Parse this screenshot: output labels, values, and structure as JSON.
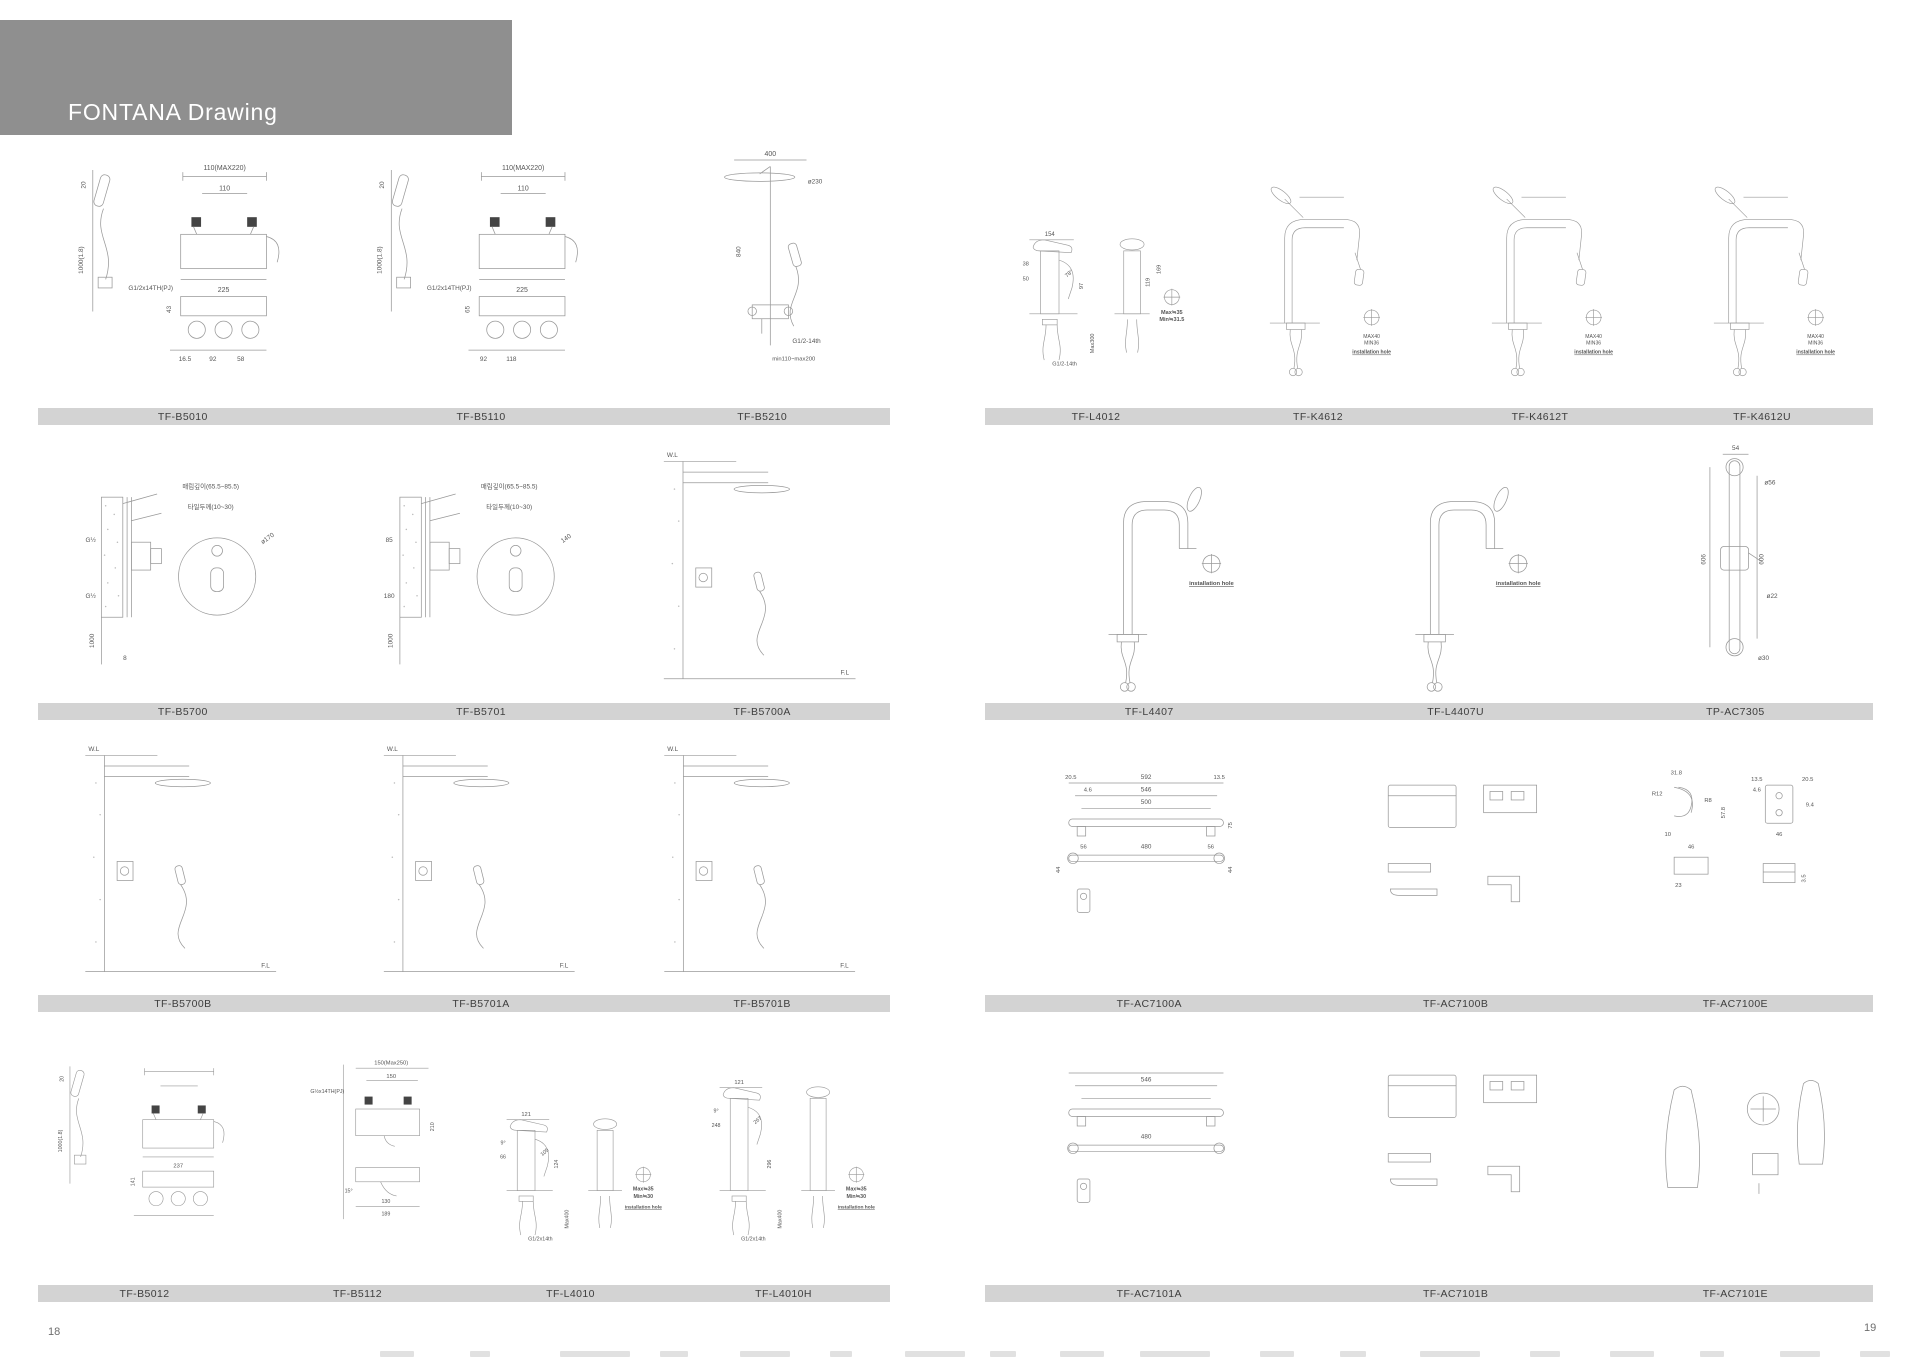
{
  "header": {
    "title": "FONTANA Drawing"
  },
  "colors": {
    "header_bar": "#8f8f8f",
    "label_bar": "#d3d3d3",
    "line": "#999999",
    "dim_text": "#555555"
  },
  "pages": [
    {
      "number": "18",
      "rows": [
        {
          "items": [
            {
              "label": "TF-B5010",
              "kind": "tub-mixer-hs",
              "annotations": [
                "110(MAX220)",
                "110",
                "20",
                "1000(1.8)",
                "G1/2x14TH(PJ)",
                "225",
                "43",
                "16.5",
                "92",
                "58"
              ]
            },
            {
              "label": "TF-B5110",
              "kind": "tub-mixer-hs",
              "annotations": [
                "110(MAX220)",
                "110",
                "20",
                "1000(1.8)",
                "G1/2x14TH(PJ)",
                "225",
                "65",
                "92",
                "118",
                ""
              ]
            },
            {
              "label": "TF-B5210",
              "kind": "shower-column",
              "annotations": [
                "400",
                "ø230",
                "840",
                "min110~max200",
                "G1/2-14th"
              ]
            }
          ]
        },
        {
          "items": [
            {
              "label": "TF-B5700",
              "kind": "concealed-valve",
              "annotations": [
                "매립깊이(65.5~85.5)",
                "타일두께(10~30)",
                "G½",
                "G½",
                "ø170",
                "1000",
                "8"
              ]
            },
            {
              "label": "TF-B5701",
              "kind": "concealed-valve",
              "annotations": [
                "매립깊이(65.5~85.5)",
                "타일두께(10~30)",
                "85",
                "180",
                "140",
                "1000",
                ""
              ]
            },
            {
              "label": "TF-B5700A",
              "kind": "shower-system",
              "annotations": [
                "W.L",
                "F.L"
              ]
            }
          ]
        },
        {
          "items": [
            {
              "label": "TF-B5700B",
              "kind": "shower-system",
              "annotations": [
                "W.L",
                "F.L"
              ]
            },
            {
              "label": "TF-B5701A",
              "kind": "shower-system",
              "annotations": [
                "W.L",
                "F.L"
              ]
            },
            {
              "label": "TF-B5701B",
              "kind": "shower-system",
              "annotations": [
                "W.L",
                "F.L"
              ]
            }
          ]
        },
        {
          "items": [
            {
              "label": "TF-B5012",
              "kind": "tub-mixer-hs",
              "annotations": [
                "",
                "",
                "20",
                "1000(1.8)",
                "",
                "237",
                "141",
                "",
                "",
                ""
              ]
            },
            {
              "label": "TF-B5112",
              "kind": "wall-mixer",
              "annotations": [
                "150(Max250)",
                "150",
                "G½x14TH(PJ)",
                "210",
                "15°",
                "130",
                "189"
              ]
            },
            {
              "label": "TF-L4010",
              "kind": "basin-mixer",
              "annotations": [
                "121",
                "9°",
                "66",
                "105",
                "124",
                "",
                "",
                "Max400",
                "Max≒35",
                "Min≒30",
                "G1/2x14th",
                "installation hole"
              ]
            },
            {
              "label": "TF-L4010H",
              "kind": "basin-mixer-tall",
              "annotations": [
                "121",
                "9°",
                "248",
                "267",
                "296",
                "",
                "",
                "Max400",
                "Max≒35",
                "Min≒30",
                "G1/2x14th",
                "installation hole"
              ]
            }
          ]
        }
      ]
    },
    {
      "number": "19",
      "rows": [
        {
          "items": [
            {
              "label": "TF-L4012",
              "kind": "basin-mixer",
              "annotations": [
                "154",
                "38",
                "50",
                "78°",
                "97",
                "119",
                "169",
                "Max300",
                "Max≒35",
                "Min≒31.5",
                "G1/2-14th",
                ""
              ]
            },
            {
              "label": "TF-K4612",
              "kind": "kitchen-faucet",
              "annotations": [
                "MAX40",
                "MIN36",
                "installation hole"
              ]
            },
            {
              "label": "TF-K4612T",
              "kind": "kitchen-faucet",
              "annotations": [
                "MAX40",
                "MIN36",
                "installation hole"
              ]
            },
            {
              "label": "TF-K4612U",
              "kind": "kitchen-faucet",
              "annotations": [
                "MAX40",
                "MIN36",
                "installation hole"
              ]
            }
          ]
        },
        {
          "items": [
            {
              "label": "TF-L4407",
              "kind": "bar-faucet",
              "annotations": [
                "installation hole"
              ]
            },
            {
              "label": "TF-L4407U",
              "kind": "bar-faucet",
              "annotations": [
                "installation hole"
              ]
            },
            {
              "label": "TP-AC7305",
              "kind": "slide-bar",
              "annotations": [
                "54",
                "ø56",
                "606",
                "600",
                "ø22",
                "ø30"
              ]
            }
          ]
        },
        {
          "items": [
            {
              "label": "TF-AC7100A",
              "kind": "towel-bar",
              "annotations": [
                "20.5",
                "4.6",
                "13.5",
                "546",
                "592",
                "500",
                "56",
                "480",
                "56",
                "75",
                "44",
                "44"
              ]
            },
            {
              "label": "TF-AC7100B",
              "kind": "accessory-set",
              "annotations": []
            },
            {
              "label": "TF-AC7100E",
              "kind": "accessory-hook",
              "annotations": [
                "31.8",
                "R12",
                "R8",
                "57.8",
                "10",
                "46",
                "23",
                "46",
                "13.5",
                "4.6",
                "20.5",
                "9.4",
                "3.5"
              ]
            }
          ]
        },
        {
          "items": [
            {
              "label": "TF-AC7101A",
              "kind": "towel-bar",
              "annotations": [
                "",
                "",
                "",
                "546",
                "",
                "",
                "",
                "480",
                "",
                "",
                "",
                ""
              ]
            },
            {
              "label": "TF-AC7101B",
              "kind": "accessory-set",
              "annotations": []
            },
            {
              "label": "TF-AC7101E",
              "kind": "accessory-misc",
              "annotations": []
            }
          ]
        }
      ]
    }
  ]
}
